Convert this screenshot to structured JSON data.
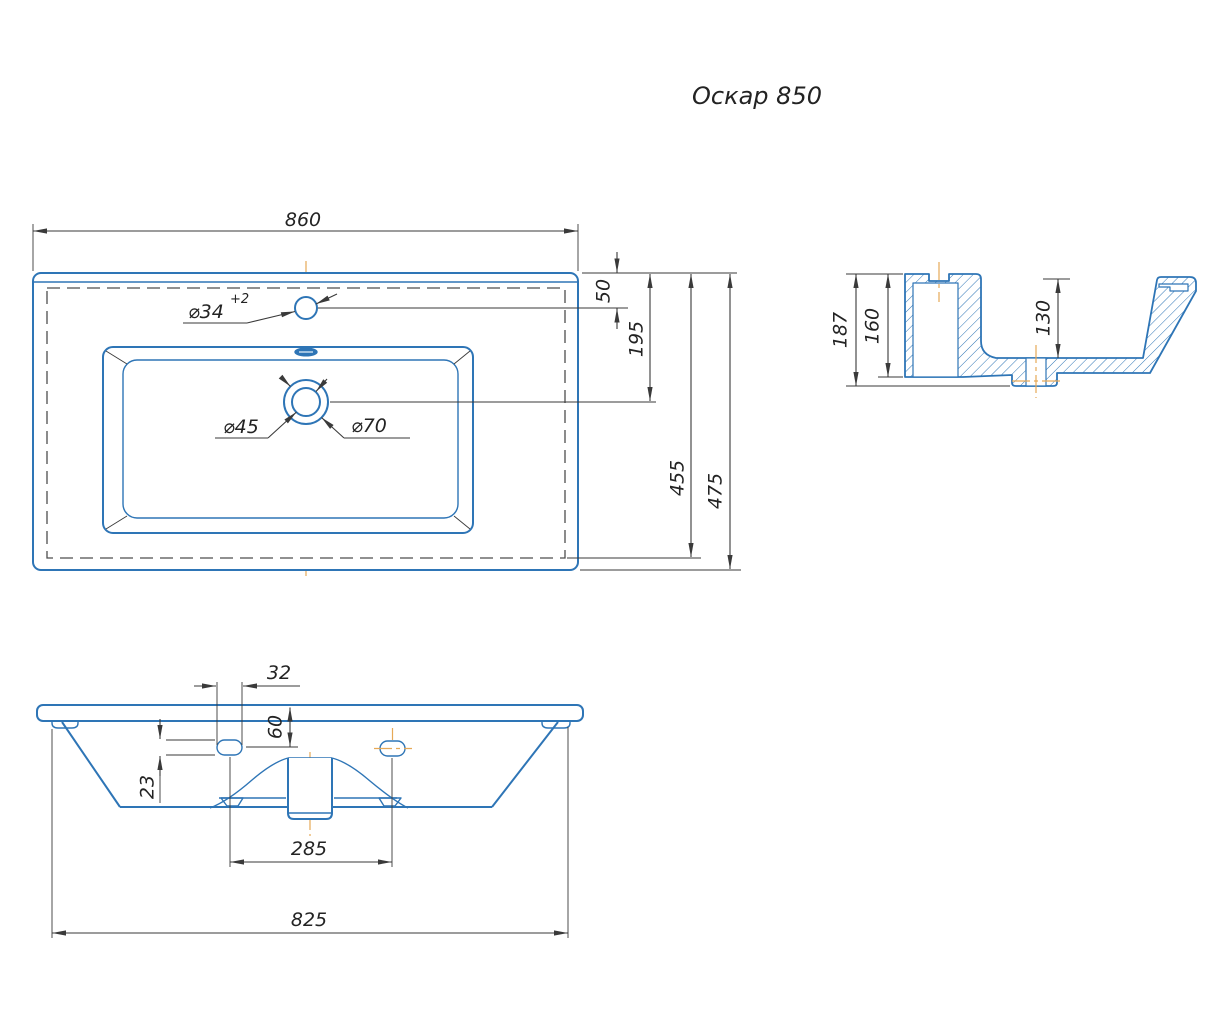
{
  "title": "Оскар 850",
  "colors": {
    "outline": "#2e75b6",
    "dimension": "#3a3a3a",
    "centerline": "#e6a957",
    "hidden": "#4d4d4d",
    "ink": "#232323",
    "background": "#ffffff"
  },
  "top_view": {
    "dim_width": "860",
    "dim_faucet_offset": "50",
    "dim_drain_offset": "195",
    "dim_inner_depth": "455",
    "dim_total_depth": "475",
    "label_faucet_hole": "⌀34",
    "label_faucet_tolerance": "+2",
    "label_drain_inner": "⌀45",
    "label_drain_outer": "⌀70"
  },
  "side_view": {
    "dim_total_height": "187",
    "dim_body_height": "160",
    "dim_basin_depth": "130"
  },
  "front_view": {
    "dim_slot_width": "32",
    "dim_slot_offset_top": "60",
    "dim_slot_height": "23",
    "dim_slot_spacing": "285",
    "dim_bottom_width": "825"
  }
}
